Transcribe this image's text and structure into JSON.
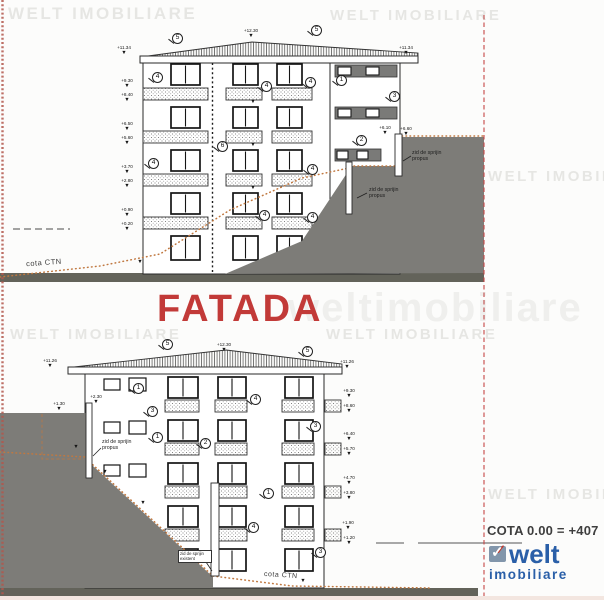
{
  "drawing": {
    "title": "FATADA",
    "cota_note": "COTA 0.00 = +407",
    "cota_ctn_label": "cota CTN",
    "retaining_wall_proposed_label": "zid de sprijin propus",
    "retaining_wall_existing_label": "zid de sprijin existent"
  },
  "watermark": {
    "text": "WELT IMOBILIARE",
    "positions": [
      {
        "x": 8,
        "y": 4,
        "s": 17
      },
      {
        "x": 330,
        "y": 7,
        "s": 15
      },
      {
        "x": 488,
        "y": 168,
        "s": 15
      },
      {
        "x": 10,
        "y": 326,
        "s": 15
      },
      {
        "x": 326,
        "y": 326,
        "s": 15
      },
      {
        "x": 488,
        "y": 486,
        "s": 15
      }
    ],
    "big": {
      "text": "weltimobiliare",
      "x": 288,
      "y": 286,
      "s": 40
    }
  },
  "logo": {
    "name": "welt",
    "subtitle": "imobiliare",
    "check_icon": "check-icon",
    "blue": "#2a5fa8",
    "red": "#c0392b"
  },
  "colors": {
    "title_red": "#c23a38",
    "terrain_gray": "#7d7c78",
    "ground_bar": "#63635a",
    "ctn_orange": "#c07840",
    "boundary_red": "#c64545",
    "logo_blue": "#2a5fa8"
  },
  "elevation_marks": {
    "top": [
      {
        "v": "+12.30",
        "x": 251,
        "y": 29
      },
      {
        "v": "+11.34",
        "x": 124,
        "y": 46
      },
      {
        "v": "+11.34",
        "x": 406,
        "y": 46
      },
      {
        "v": "+9.30",
        "x": 127,
        "y": 79
      },
      {
        "v": "+8.40",
        "x": 127,
        "y": 93
      },
      {
        "v": "+6.50",
        "x": 127,
        "y": 122
      },
      {
        "v": "+5.60",
        "x": 127,
        "y": 136
      },
      {
        "v": "+3.70",
        "x": 127,
        "y": 165
      },
      {
        "v": "+2.80",
        "x": 127,
        "y": 179
      },
      {
        "v": "+0.90",
        "x": 127,
        "y": 208
      },
      {
        "v": "+0.20",
        "x": 127,
        "y": 222
      },
      {
        "v": "+6.10",
        "x": 385,
        "y": 126
      },
      {
        "v": "+6.60",
        "x": 406,
        "y": 127
      },
      {
        "v": "",
        "x": 253,
        "y": 100
      },
      {
        "v": "",
        "x": 253,
        "y": 143
      },
      {
        "v": "",
        "x": 253,
        "y": 186
      },
      {
        "v": "",
        "x": 140,
        "y": 260
      }
    ],
    "bottom": [
      {
        "v": "+12.30",
        "x": 224,
        "y": 343
      },
      {
        "v": "+11.26",
        "x": 50,
        "y": 359
      },
      {
        "v": "+11.26",
        "x": 347,
        "y": 360
      },
      {
        "v": "+9.30",
        "x": 349,
        "y": 389
      },
      {
        "v": "+8.60",
        "x": 349,
        "y": 404
      },
      {
        "v": "+6.40",
        "x": 349,
        "y": 432
      },
      {
        "v": "+5.70",
        "x": 349,
        "y": 447
      },
      {
        "v": "+4.70",
        "x": 349,
        "y": 476
      },
      {
        "v": "+3.80",
        "x": 349,
        "y": 491
      },
      {
        "v": "+1.90",
        "x": 348,
        "y": 521
      },
      {
        "v": "+1.20",
        "x": 349,
        "y": 536
      },
      {
        "v": "+2.30",
        "x": 96,
        "y": 395
      },
      {
        "v": "+1.30",
        "x": 59,
        "y": 402
      },
      {
        "v": "",
        "x": 76,
        "y": 445
      },
      {
        "v": "",
        "x": 105,
        "y": 470
      },
      {
        "v": "",
        "x": 143,
        "y": 501
      },
      {
        "v": "",
        "x": 303,
        "y": 579
      }
    ]
  },
  "callouts": {
    "top": [
      {
        "n": "5",
        "x": 177,
        "y": 38
      },
      {
        "n": "5",
        "x": 316,
        "y": 30
      },
      {
        "n": "4",
        "x": 157,
        "y": 77
      },
      {
        "n": "4",
        "x": 266,
        "y": 86
      },
      {
        "n": "4",
        "x": 310,
        "y": 82
      },
      {
        "n": "4",
        "x": 153,
        "y": 163
      },
      {
        "n": "4",
        "x": 264,
        "y": 215
      },
      {
        "n": "4",
        "x": 312,
        "y": 169
      },
      {
        "n": "4",
        "x": 312,
        "y": 217
      },
      {
        "n": "6",
        "x": 222,
        "y": 146
      },
      {
        "n": "1",
        "x": 341,
        "y": 80
      },
      {
        "n": "3",
        "x": 394,
        "y": 96
      },
      {
        "n": "2",
        "x": 361,
        "y": 140
      }
    ],
    "bottom": [
      {
        "n": "5",
        "x": 167,
        "y": 344
      },
      {
        "n": "5",
        "x": 307,
        "y": 351
      },
      {
        "n": "1",
        "x": 138,
        "y": 388
      },
      {
        "n": "3",
        "x": 152,
        "y": 411
      },
      {
        "n": "1",
        "x": 157,
        "y": 437
      },
      {
        "n": "2",
        "x": 205,
        "y": 443
      },
      {
        "n": "4",
        "x": 255,
        "y": 399
      },
      {
        "n": "1",
        "x": 268,
        "y": 493
      },
      {
        "n": "4",
        "x": 253,
        "y": 527
      },
      {
        "n": "3",
        "x": 315,
        "y": 426
      },
      {
        "n": "3",
        "x": 320,
        "y": 552
      }
    ]
  }
}
